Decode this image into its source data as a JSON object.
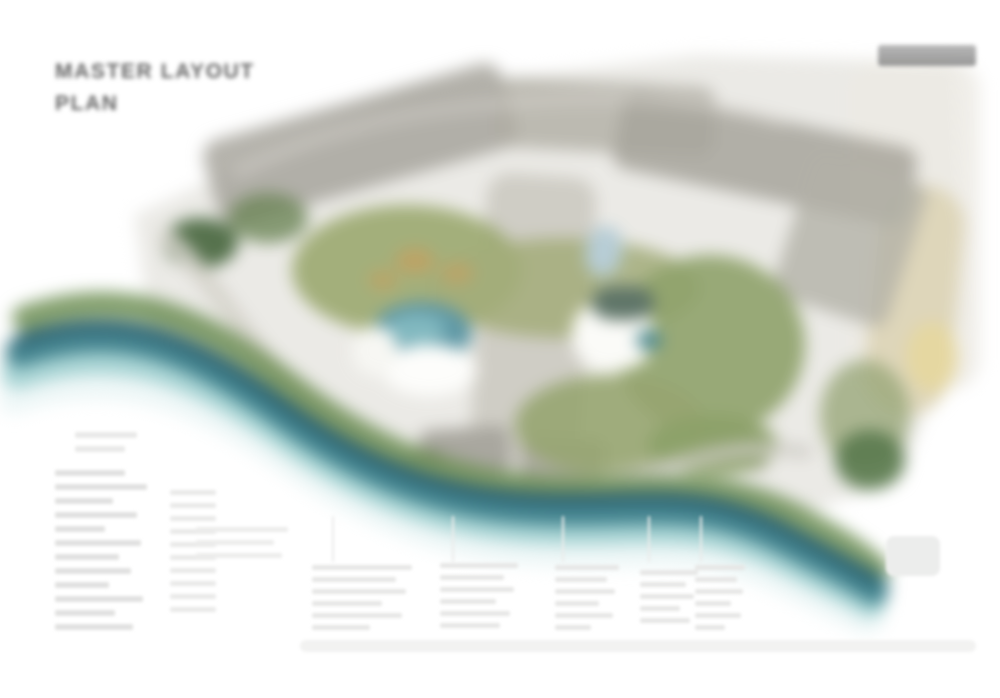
{
  "header": {
    "title_line1": "MASTER LAYOUT",
    "title_line2": "PLAN"
  },
  "branding": {
    "logo_icon": "gray-logo-bar",
    "logo_text_visible": false
  },
  "plan": {
    "features": {
      "river": "teal-waterway-icon",
      "pools": "swimming-pool-icon",
      "greenery": "landscaped-garden-icon",
      "buildings": "building-block-icon",
      "beach": "sand-beach-icon",
      "roads": "internal-road-icon"
    },
    "colors": {
      "river_dark": "#2a5f6e",
      "river_main": "#3f818c",
      "river_light": "#9ccfcf",
      "river_bank_green": "#6f8f55",
      "greenery": "#9ba970",
      "greenery_dark": "#4e6b44",
      "building_gray": "#a8a69d",
      "paving": "#cbc9c0",
      "sand": "#ddd4b6",
      "sand_highlight": "#e6d79e",
      "pool_blue": "#5f98a5",
      "pool_deck_white": "#fdfdfb",
      "title_text": "#656565",
      "legend_text_faint": "#e2e2e1"
    }
  },
  "legend": {
    "legibility": "illegible-blurred-text",
    "left_column_rows": 12,
    "bottom_columns": 5
  }
}
